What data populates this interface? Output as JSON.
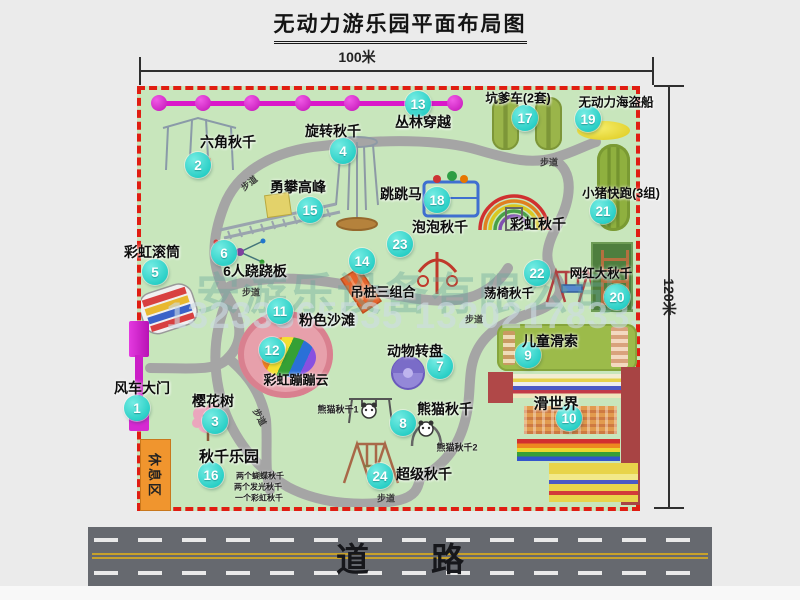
{
  "title": "无动力游乐园平面布局图",
  "dimensions": {
    "top": "100米",
    "right": "120米"
  },
  "road": {
    "label": "道路"
  },
  "watermark": {
    "company": "安游乐设备有限公司",
    "phone": "13233865535 13202178333"
  },
  "rest_area": {
    "label": "休息区"
  },
  "path_label_text": "步道",
  "path_labels": [
    {
      "x": 249,
      "y": 183,
      "rot": -38
    },
    {
      "x": 549,
      "y": 162,
      "rot": 0
    },
    {
      "x": 251,
      "y": 292,
      "rot": 0
    },
    {
      "x": 474,
      "y": 319,
      "rot": 0
    },
    {
      "x": 386,
      "y": 498,
      "rot": 0
    },
    {
      "x": 260,
      "y": 417,
      "rot": 62
    }
  ],
  "zipline": {
    "dots_x": [
      159,
      203,
      252,
      303,
      352,
      415,
      455
    ]
  },
  "markers": [
    {
      "num": "1",
      "label": "风车大门",
      "cx": 137,
      "cy": 408,
      "lx": 142,
      "ly": 388
    },
    {
      "num": "2",
      "label": "六角秋千",
      "cx": 198,
      "cy": 165,
      "lx": 228,
      "ly": 142
    },
    {
      "num": "3",
      "label": "樱花树",
      "cx": 215,
      "cy": 421,
      "lx": 213,
      "ly": 401
    },
    {
      "num": "4",
      "label": "旋转秋千",
      "cx": 343,
      "cy": 151,
      "lx": 333,
      "ly": 131
    },
    {
      "num": "5",
      "label": "彩虹滚筒",
      "cx": 155,
      "cy": 272,
      "lx": 152,
      "ly": 252
    },
    {
      "num": "6",
      "label": "6人跷跷板",
      "cx": 224,
      "cy": 253,
      "lx": 255,
      "ly": 271
    },
    {
      "num": "7",
      "label": "动物转盘",
      "cx": 440,
      "cy": 366,
      "lx": 415,
      "ly": 351
    },
    {
      "num": "8",
      "label": "熊猫秋千",
      "cx": 403,
      "cy": 423,
      "lx": 445,
      "ly": 409
    },
    {
      "num": "9",
      "label": "儿童滑索",
      "cx": 528,
      "cy": 355,
      "lx": 550,
      "ly": 341
    },
    {
      "num": "10",
      "label": "滑世界",
      "cx": 569,
      "cy": 418,
      "lx": 556,
      "ly": 403,
      "fs": 15
    },
    {
      "num": "11",
      "label": "粉色沙滩",
      "cx": 280,
      "cy": 311,
      "lx": 327,
      "ly": 320
    },
    {
      "num": "12",
      "label": "彩虹蹦蹦云",
      "cx": 272,
      "cy": 350,
      "lx": 296,
      "ly": 379,
      "fs": 13
    },
    {
      "num": "13",
      "label": "丛林穿越",
      "cx": 418,
      "cy": 104,
      "lx": 423,
      "ly": 122
    },
    {
      "num": "14",
      "label": "吊桩三组合",
      "cx": 362,
      "cy": 261,
      "lx": 383,
      "ly": 291,
      "fs": 13
    },
    {
      "num": "15",
      "label": "勇攀高峰",
      "cx": 310,
      "cy": 210,
      "lx": 298,
      "ly": 187
    },
    {
      "num": "16",
      "label": "秋千乐园",
      "cx": 211,
      "cy": 475,
      "lx": 229,
      "ly": 456,
      "fs": 15
    },
    {
      "num": "17",
      "label": "坑爹车(2套)",
      "cx": 525,
      "cy": 118,
      "lx": 518,
      "ly": 97,
      "fs": 12.5
    },
    {
      "num": "18",
      "label": "跳跳马",
      "cx": 437,
      "cy": 200,
      "lx": 401,
      "ly": 194
    },
    {
      "num": "19",
      "label": "无动力海盗船",
      "cx": 588,
      "cy": 119,
      "lx": 616,
      "ly": 101,
      "fs": 12.5
    },
    {
      "num": "20",
      "label": "网红大秋千",
      "cx": 617,
      "cy": 297,
      "lx": 601,
      "ly": 272,
      "fs": 12.5
    },
    {
      "num": "21",
      "label": "小猪快跑(3组)",
      "cx": 603,
      "cy": 211,
      "lx": 621,
      "ly": 192,
      "fs": 12.5
    },
    {
      "num": "22",
      "label": "荡椅秋千",
      "cx": 537,
      "cy": 273,
      "lx": 509,
      "ly": 292,
      "fs": 12.5
    },
    {
      "num": "23",
      "label": "泡泡秋千",
      "cx": 400,
      "cy": 244,
      "lx": 440,
      "ly": 227
    },
    {
      "num": "24",
      "label": "超级秋千",
      "cx": 380,
      "cy": 476,
      "lx": 424,
      "ly": 474
    }
  ],
  "extra_labels": [
    {
      "text": "彩虹秋千",
      "x": 538,
      "y": 224,
      "fs": 14,
      "main": true
    },
    {
      "text": "熊猫秋千1",
      "x": 338,
      "y": 409,
      "fs": 9
    },
    {
      "text": "熊猫秋千2",
      "x": 457,
      "y": 447,
      "fs": 9
    },
    {
      "text": "两个蝴蝶秋千",
      "x": 260,
      "y": 476,
      "fs": 8
    },
    {
      "text": "两个发光秋千",
      "x": 258,
      "y": 487,
      "fs": 8
    },
    {
      "text": "一个彩虹秋千",
      "x": 259,
      "y": 498,
      "fs": 8
    }
  ]
}
